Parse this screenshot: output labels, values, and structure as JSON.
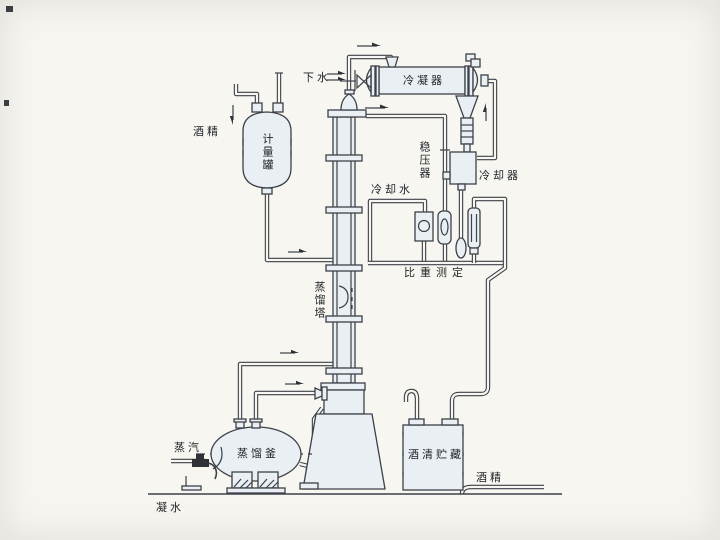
{
  "diagram": {
    "type": "process-flow-diagram",
    "labels": {
      "drain_water": "下水",
      "condenser": "冷凝器",
      "pressure_stabilizer": "稳压器",
      "cooler": "冷却器",
      "cooling_water": "冷却水",
      "specific_gravity_measurement": "比重测定",
      "alcohol_feed": "酒精",
      "metering_tank": "计量罐",
      "distillation_tower": "蒸馏塔",
      "steam": "蒸汽",
      "distillation_kettle": "蒸馏釜",
      "condensate_water": "凝水",
      "alcohol_storage": "酒清贮藏",
      "alcohol_product": "酒精"
    },
    "colors": {
      "background": "#f7f6f1",
      "line": "#3c4148",
      "vessel_fill": "#e9eff3",
      "text": "#22252a"
    }
  }
}
